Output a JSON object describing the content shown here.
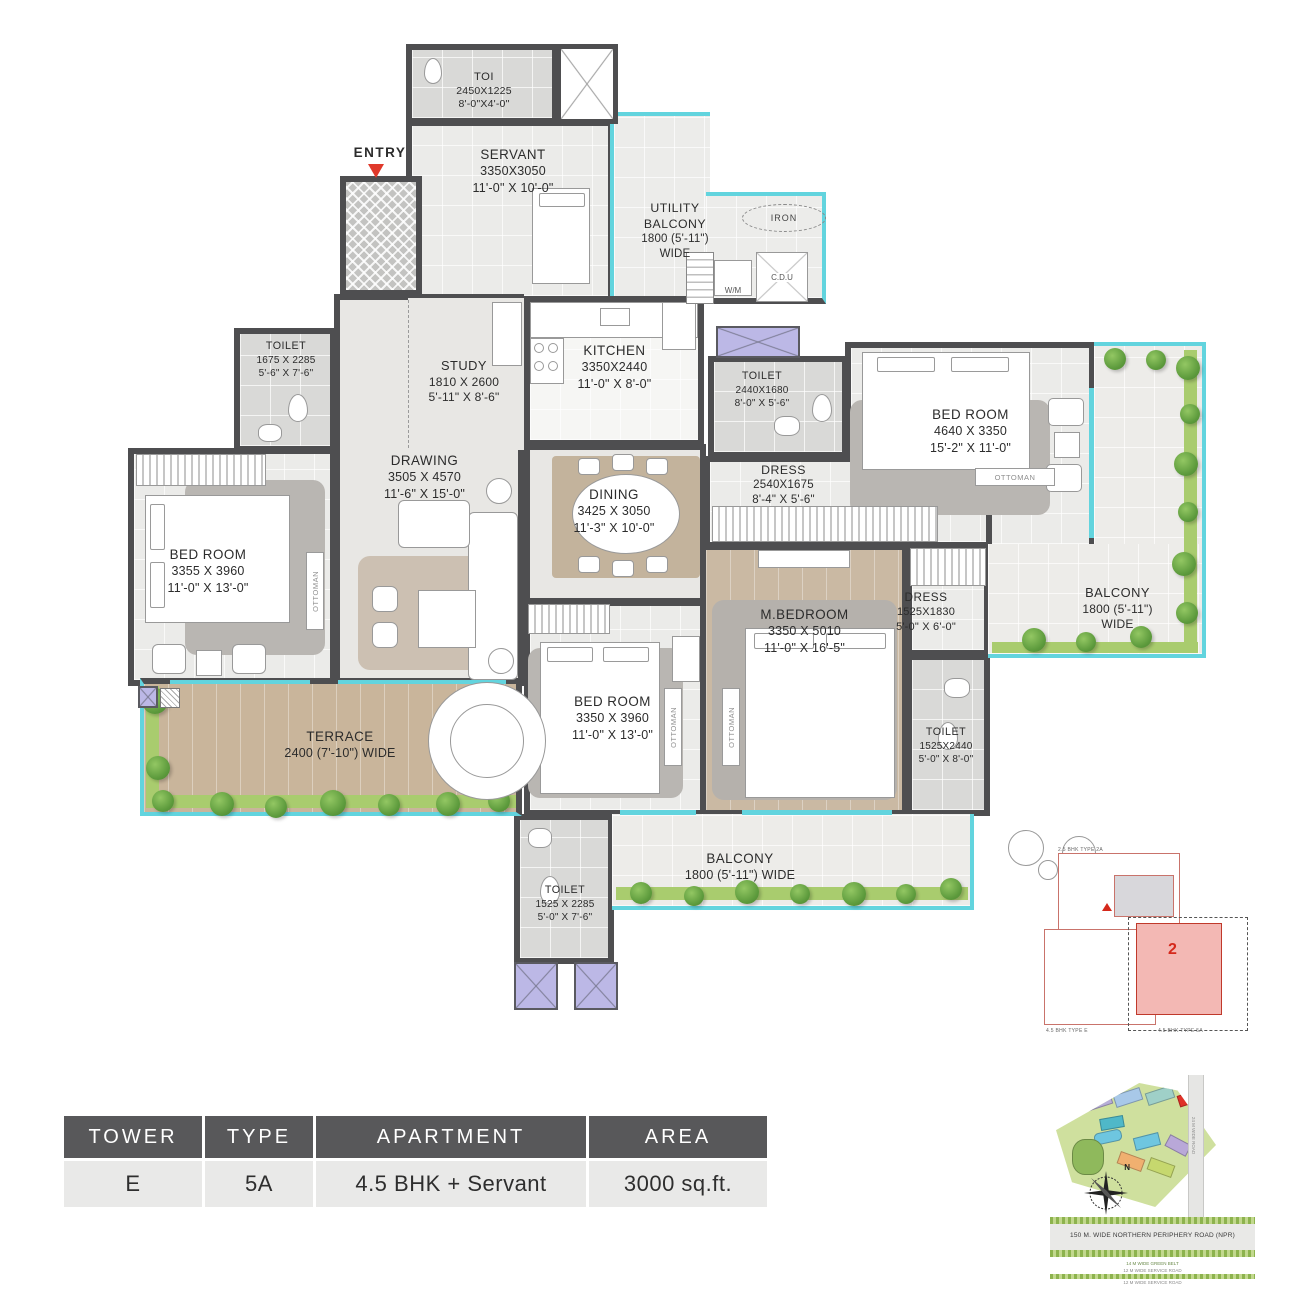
{
  "colors": {
    "wall": "#4e4e50",
    "glass": "#62d4de",
    "planter_green": "#a9cc6e",
    "shaft_purple": "#bcb8e6",
    "accent_red": "#d5281b",
    "table_header_bg": "#58585a"
  },
  "plan": {
    "entry_label": "ENTRY",
    "ottoman": "OTTOMAN",
    "small": {
      "iron": "IRON",
      "wm": "W/M",
      "cdu": "C.D.U"
    },
    "rooms": {
      "toi": {
        "lines": [
          "TOI",
          "2450X1225",
          "8'-0\"X4'-0\""
        ]
      },
      "servant": {
        "lines": [
          "SERVANT",
          "3350X3050",
          "11'-0\" X 10'-0\""
        ]
      },
      "utility": {
        "lines": [
          "UTILITY",
          "BALCONY",
          "1800 (5'-11\")",
          "WIDE"
        ]
      },
      "toilet1": {
        "lines": [
          "TOILET",
          "1675 X 2285",
          "5'-6\" X 7'-6\""
        ]
      },
      "study": {
        "lines": [
          "STUDY",
          "1810 X 2600",
          "5'-11\" X 8'-6\""
        ]
      },
      "kitchen": {
        "lines": [
          "KITCHEN",
          "3350X2440",
          "11'-0\" X 8'-0\""
        ]
      },
      "toilet2": {
        "lines": [
          "TOILET",
          "2440X1680",
          "8'-0\" X 5'-6\""
        ]
      },
      "bedroom_right": {
        "lines": [
          "BED ROOM",
          "4640 X 3350",
          "15'-2\" X 11'-0\""
        ]
      },
      "drawing": {
        "lines": [
          "DRAWING",
          "3505 X 4570",
          "11'-6\" X 15'-0\""
        ]
      },
      "dining": {
        "lines": [
          "DINING",
          "3425 X 3050",
          "11'-3\" X 10'-0\""
        ]
      },
      "dress1": {
        "lines": [
          "DRESS",
          "2540X1675",
          "8'-4\" X 5'-6\""
        ]
      },
      "bedroom_left": {
        "lines": [
          "BED ROOM",
          "3355 X 3960",
          "11'-0\" X 13'-0\""
        ]
      },
      "balcony_right": {
        "lines": [
          "BALCONY",
          "1800 (5'-11\")",
          "WIDE"
        ]
      },
      "mbedroom": {
        "lines": [
          "M.BEDROOM",
          "3350 X 5010",
          "11'-0\" X 16'-5\""
        ]
      },
      "dress2": {
        "lines": [
          "DRESS",
          "1525X1830",
          "5'-0\" X 6'-0\""
        ]
      },
      "toilet3": {
        "lines": [
          "TOILET",
          "1525X2440",
          "5'-0\" X 8'-0\""
        ]
      },
      "terrace": {
        "lines": [
          "TERRACE",
          "2400 (7'-10\") WIDE"
        ]
      },
      "bedroom_bottom": {
        "lines": [
          "BED ROOM",
          "3350 X 3960",
          "11'-0\" X 13'-0\""
        ]
      },
      "toilet4": {
        "lines": [
          "TOILET",
          "1525 X 2285",
          "5'-0\" X 7'-6\""
        ]
      },
      "balcony_bottom": {
        "lines": [
          "BALCONY",
          "1800 (5'-11\") WIDE"
        ]
      }
    }
  },
  "info_table": {
    "headers": [
      "TOWER",
      "TYPE",
      "APARTMENT",
      "AREA"
    ],
    "values": [
      "E",
      "5A",
      "4.5 BHK + Servant",
      "3000 sq.ft."
    ]
  },
  "keyplan": {
    "unit_number": "2",
    "label_top": "2.5 BHK TYPE 2A",
    "label_left": "4.5 BHK TYPE E",
    "label_right": "4.5 BHK TYPE 5A"
  },
  "sitemap": {
    "npr_road": "150 M. WIDE NORTHERN PERIPHERY ROAD (NPR)",
    "green_belt": "14 M WIDE GREEN BELT",
    "service_road1": "12 M WIDE SERVICE ROAD",
    "service_road2": "12 M WIDE SERVICE ROAD",
    "side_road": "24 M WIDE ROAD",
    "compass_north": "N"
  }
}
